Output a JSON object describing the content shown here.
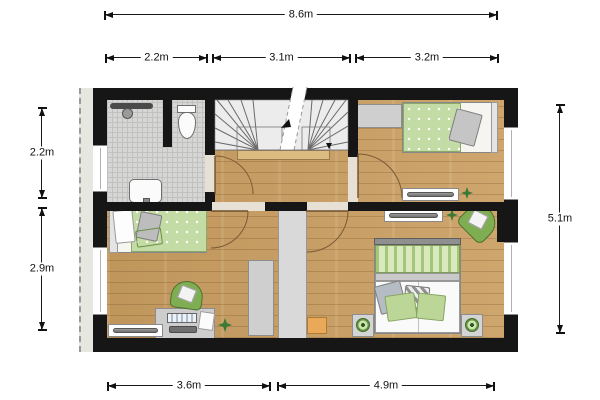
{
  "dimensions": {
    "top_total": {
      "label": "8.6m"
    },
    "top_segments": [
      {
        "label": "2.2m"
      },
      {
        "label": "3.1m"
      },
      {
        "label": "3.2m"
      }
    ],
    "left_segments": [
      {
        "label": "2.2m"
      },
      {
        "label": "2.9m"
      }
    ],
    "right_total": {
      "label": "5.1m"
    },
    "bottom_segments": [
      {
        "label": "3.6m"
      },
      {
        "label": "4.9m"
      }
    ]
  },
  "plan": {
    "type": "floor-plan",
    "rooms": [
      {
        "name": "bathroom",
        "floor": "tiles",
        "symbols": [
          "shower-rail",
          "shower-head",
          "toilet",
          "sink"
        ]
      },
      {
        "name": "staircase",
        "symbols": [
          "winder-stairs",
          "cut-line",
          "direction-arrows"
        ]
      },
      {
        "name": "landing",
        "floor": "wood",
        "symbols": [
          "door-arc-bathroom",
          "door-arc-bedrooms"
        ]
      },
      {
        "name": "bedroom-top-right",
        "floor": "wood",
        "symbols": [
          "wardrobe",
          "single-bed",
          "pillow",
          "radiator",
          "plant"
        ]
      },
      {
        "name": "bedroom-bottom-left",
        "floor": "wood",
        "symbols": [
          "single-bed",
          "pillows",
          "wardrobe",
          "desk",
          "keyboard",
          "papers",
          "desk-chair",
          "radiator",
          "plant"
        ]
      },
      {
        "name": "bedroom-bottom-right",
        "floor": "wood",
        "symbols": [
          "double-bed",
          "pillows",
          "nightstand-left",
          "nightstand-right",
          "lamps",
          "armchair",
          "radiator",
          "plant",
          "stool"
        ]
      }
    ]
  },
  "colors": {
    "wall": "#161616",
    "wood_floor": "#c89e63",
    "tile_floor": "#d6d6d4",
    "green_furniture": "#7fae52",
    "green_textile": "#c3dba4",
    "gray_furniture": "#cfcfcf",
    "orange_stool": "#e9a959",
    "dimension_line": "#111111"
  }
}
